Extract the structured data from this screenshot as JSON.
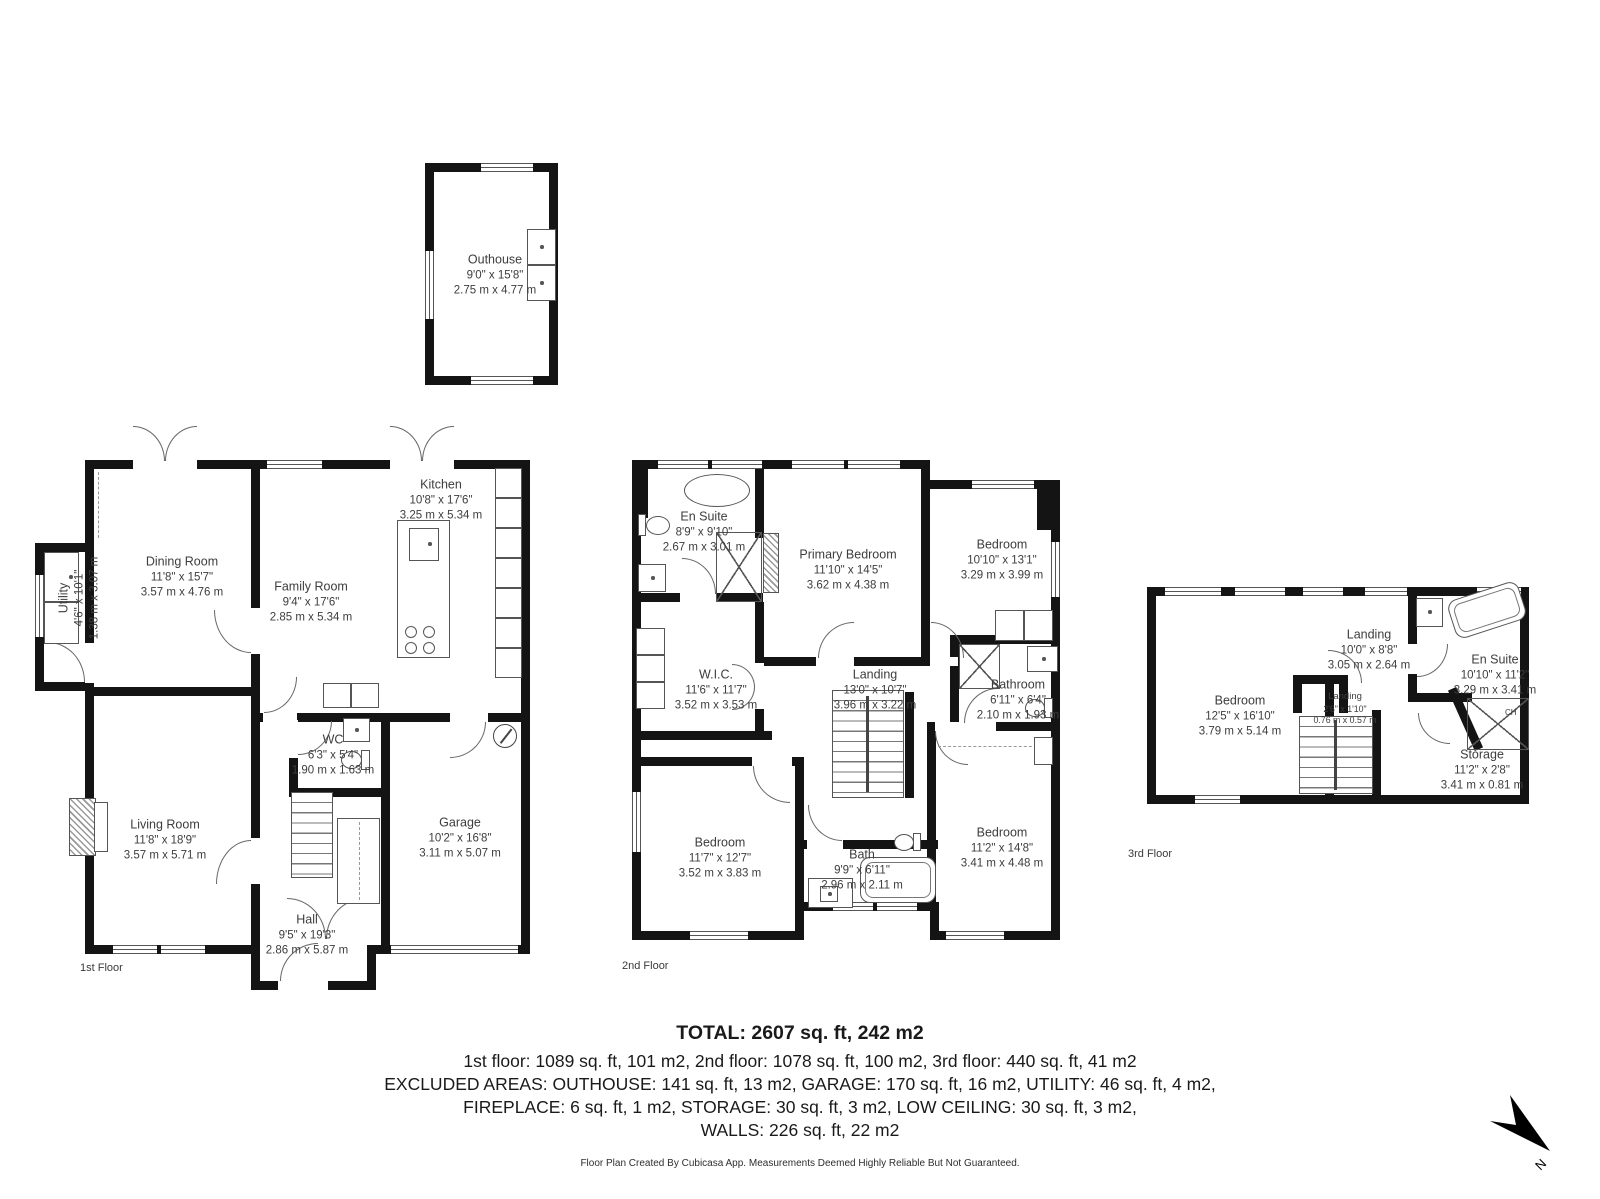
{
  "meta": {
    "footer": "Floor Plan Created By Cubicasa App. Measurements Deemed Highly Reliable But Not Guaranteed.",
    "compass_label": "N"
  },
  "summary": {
    "total": "TOTAL: 2607 sq. ft, 242 m2",
    "line1": "1st floor: 1089 sq. ft, 101 m2, 2nd floor: 1078 sq. ft, 100 m2, 3rd floor: 440 sq. ft, 41 m2",
    "line2": "EXCLUDED AREAS: OUTHOUSE: 141 sq. ft, 13 m2, GARAGE: 170 sq. ft, 16 m2, UTILITY: 46 sq. ft, 4 m2,",
    "line3": "FIREPLACE: 6 sq. ft, 1 m2, STORAGE: 30 sq. ft, 3 m2, LOW CEILING: 30 sq. ft, 3 m2,",
    "line4": "WALLS: 226 sq. ft, 22 m2"
  },
  "outhouse": {
    "name": "Outhouse",
    "ft": "9'0\" x 15'8\"",
    "m": "2.75 m x 4.77 m"
  },
  "floor1": {
    "label": "1st Floor",
    "rooms": {
      "dining": {
        "name": "Dining Room",
        "ft": "11'8\" x 15'7\"",
        "m": "3.57 m x 4.76 m"
      },
      "utility": {
        "name": "Utility",
        "ft": "4'6\" x 10'1\"",
        "m": "1.38 m x 3.07 m"
      },
      "kitchen": {
        "name": "Kitchen",
        "ft": "10'8\" x 17'6\"",
        "m": "3.25 m x 5.34 m"
      },
      "family": {
        "name": "Family Room",
        "ft": "9'4\" x 17'6\"",
        "m": "2.85 m x 5.34 m"
      },
      "living": {
        "name": "Living Room",
        "ft": "11'8\" x 18'9\"",
        "m": "3.57 m x 5.71 m"
      },
      "wc": {
        "name": "WC",
        "ft": "6'3\" x 5'4\"",
        "m": "1.90 m x 1.63 m"
      },
      "garage": {
        "name": "Garage",
        "ft": "10'2\" x 16'8\"",
        "m": "3.11 m x 5.07 m"
      },
      "hall": {
        "name": "Hall",
        "ft": "9'5\" x 19'3\"",
        "m": "2.86 m x 5.87 m"
      }
    }
  },
  "floor2": {
    "label": "2nd Floor",
    "rooms": {
      "ensuite": {
        "name": "En Suite",
        "ft": "8'9\" x 9'10\"",
        "m": "2.67 m x 3.01 m"
      },
      "primary": {
        "name": "Primary Bedroom",
        "ft": "11'10\" x 14'5\"",
        "m": "3.62 m x 4.38 m"
      },
      "bedroom_tr": {
        "name": "Bedroom",
        "ft": "10'10\" x 13'1\"",
        "m": "3.29 m x 3.99 m"
      },
      "wic": {
        "name": "W.I.C.",
        "ft": "11'6\" x 11'7\"",
        "m": "3.52 m x 3.53 m"
      },
      "landing": {
        "name": "Landing",
        "ft": "13'0\" x 10'7\"",
        "m": "3.96 m x 3.22 m"
      },
      "bathroom": {
        "name": "Bathroom",
        "ft": "6'11\" x 6'4\"",
        "m": "2.10 m x 1.93 m"
      },
      "bedroom_bl": {
        "name": "Bedroom",
        "ft": "11'7\" x 12'7\"",
        "m": "3.52 m x 3.83 m"
      },
      "bath": {
        "name": "Bath",
        "ft": "9'9\" x 6'11\"",
        "m": "2.96 m x 2.11 m"
      },
      "bedroom_br": {
        "name": "Bedroom",
        "ft": "11'2\" x 14'8\"",
        "m": "3.41 m x 4.48 m"
      }
    }
  },
  "floor3": {
    "label": "3rd Floor",
    "rooms": {
      "bedroom": {
        "name": "Bedroom",
        "ft": "12'5\" x 16'10\"",
        "m": "3.79 m x 5.14 m"
      },
      "landing": {
        "name": "Landing",
        "ft": "10'0\" x 8'8\"",
        "m": "3.05 m x 2.64 m"
      },
      "landing_small": {
        "name": "Landing",
        "ft": "2'6\" x 1'10\"",
        "m": "0.76 m x 0.57 m"
      },
      "ensuite": {
        "name": "En Suite",
        "ft": "10'10\" x 11'2\"",
        "m": "3.29 m x 3.41 m"
      },
      "storage": {
        "name": "Storage",
        "ft": "11'2\" x 2'8\"",
        "m": "3.41 m x 0.81 m"
      },
      "ch": "CH"
    }
  }
}
